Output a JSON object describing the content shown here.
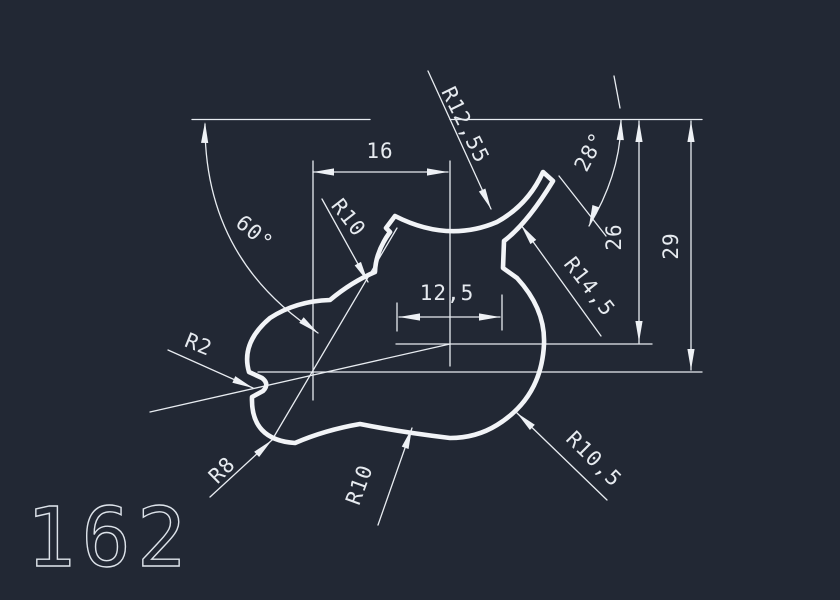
{
  "window": {
    "background_color": "#222834",
    "line_color": "#eef1f5"
  },
  "drawing": {
    "part_number": "162",
    "labels": {
      "angle_main": "60°",
      "width_top": "16",
      "radius_top_left": "R10",
      "radius_top_center": "R12,55",
      "angle_small": "28°",
      "height_inner": "26",
      "height_outer": "29",
      "width_inner": "12,5",
      "radius_right_upper": "R14,5",
      "radius_notch": "R2",
      "radius_bottom_left": "R8",
      "radius_bottom_center": "R10",
      "radius_bottom_right": "R10,5"
    }
  }
}
